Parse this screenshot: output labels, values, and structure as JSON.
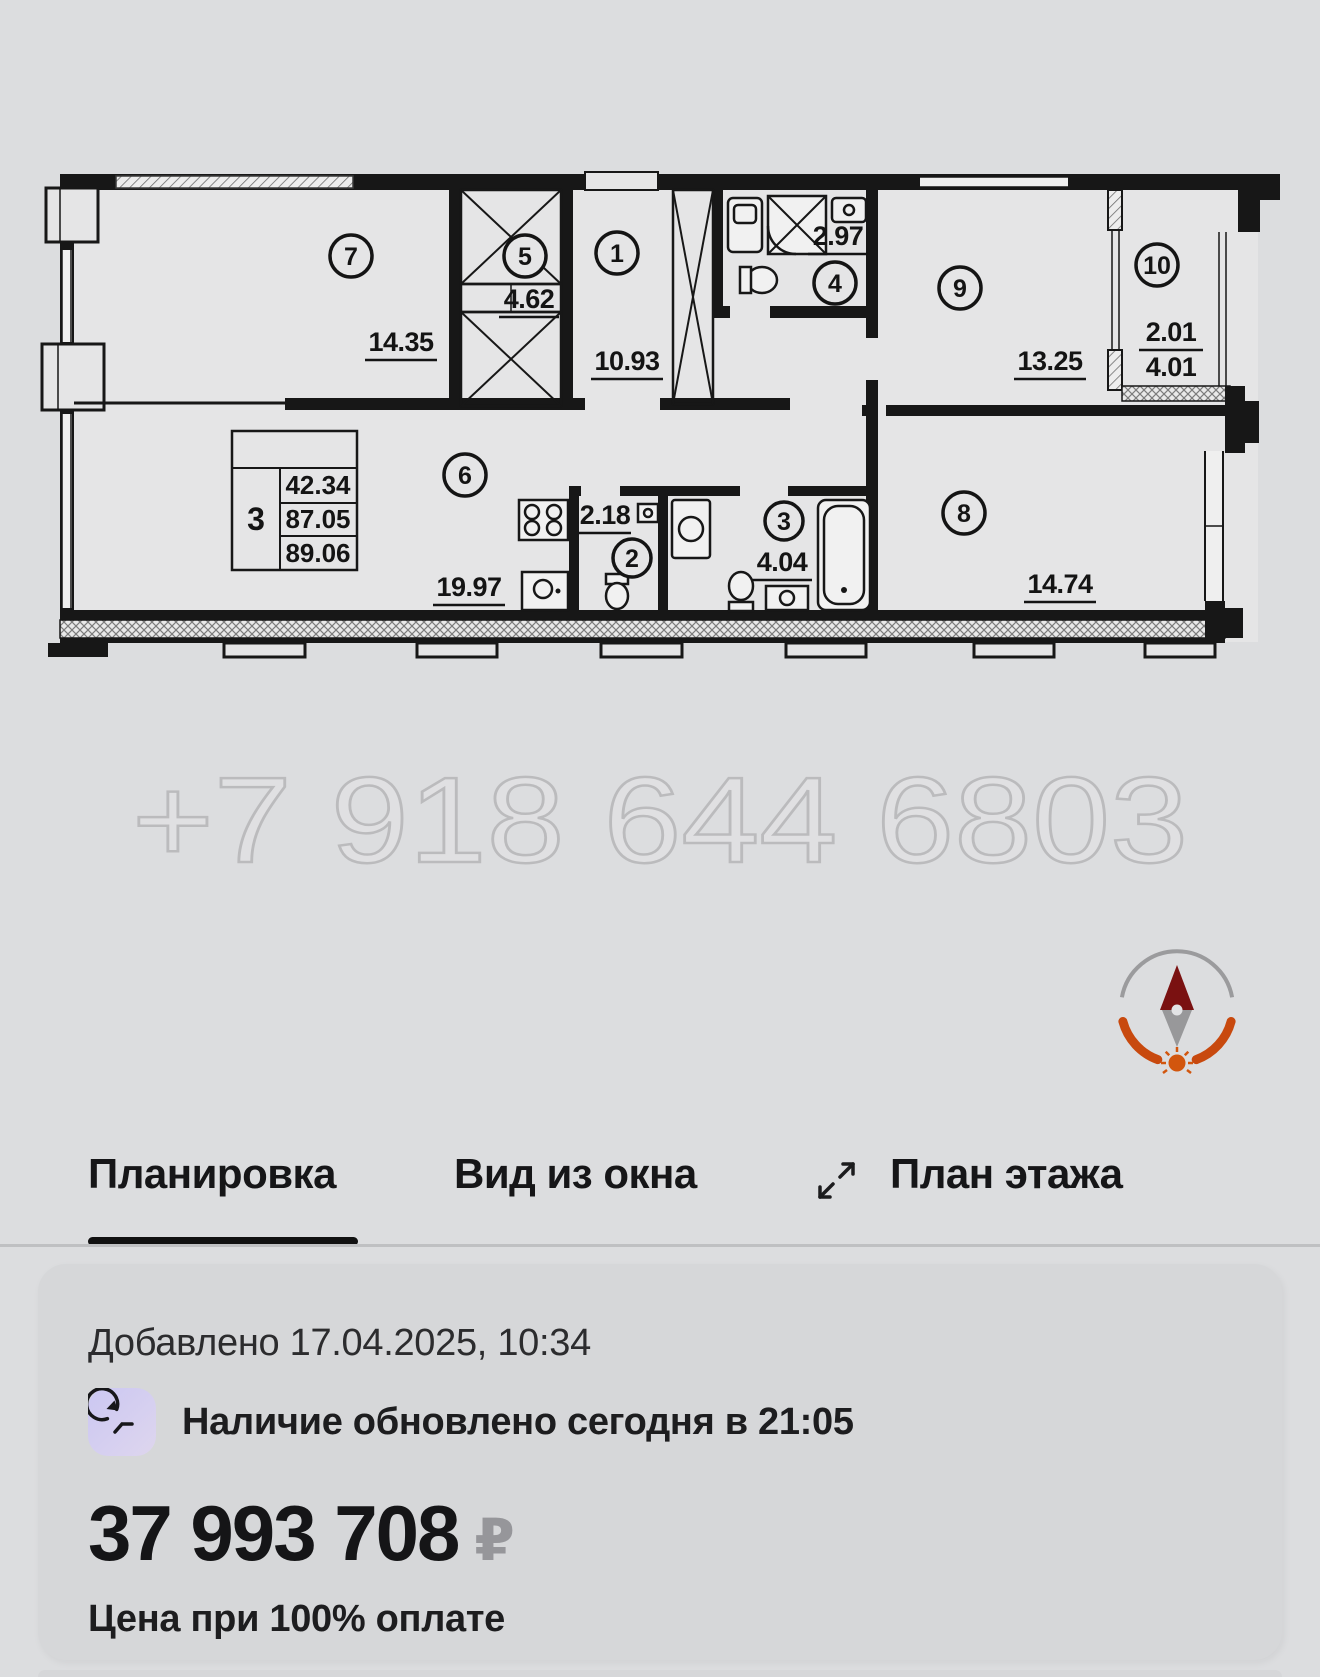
{
  "floor_plan": {
    "watermark": "+7 918 644 6803",
    "info_table": {
      "rooms_count": "3",
      "values": [
        "42.34",
        "87.05",
        "89.06"
      ]
    },
    "rooms": [
      {
        "number": "7",
        "area": "14.35"
      },
      {
        "number": "5",
        "area": "4.62"
      },
      {
        "number": "1",
        "area": "10.93"
      },
      {
        "number": "4",
        "area": "2.97"
      },
      {
        "number": "9",
        "area": "13.25"
      },
      {
        "number": "10",
        "area": "2.01",
        "area_lower": "4.01"
      },
      {
        "number": "6",
        "area": "19.97"
      },
      {
        "number": "2",
        "area": "2.18"
      },
      {
        "number": "3",
        "area": "4.04"
      },
      {
        "number": "8",
        "area": "14.74"
      }
    ]
  },
  "tabs": {
    "items": [
      {
        "label": "Планировка",
        "active": true
      },
      {
        "label": "Вид из окна",
        "active": false
      },
      {
        "label": "План этажа",
        "active": false
      }
    ]
  },
  "card": {
    "added_label": "Добавлено 17.04.2025, 10:34",
    "availability_label": "Наличие обновлено сегодня в 21:05",
    "price": "37 993 708",
    "currency_symbol": "₽",
    "price_note": "Цена при 100% оплате"
  },
  "colors": {
    "page_bg": "#dcdddf",
    "card_bg": "#d6d7d9",
    "wall_black": "#171717",
    "compass_orange": "#c8490e",
    "compass_arrow_red": "#7a1111",
    "currency_gray": "#96969a",
    "tab_underline": "#111111",
    "clock_icon_lavender_1": "#cbc7f2",
    "clock_icon_lavender_2": "#ded6ee"
  }
}
